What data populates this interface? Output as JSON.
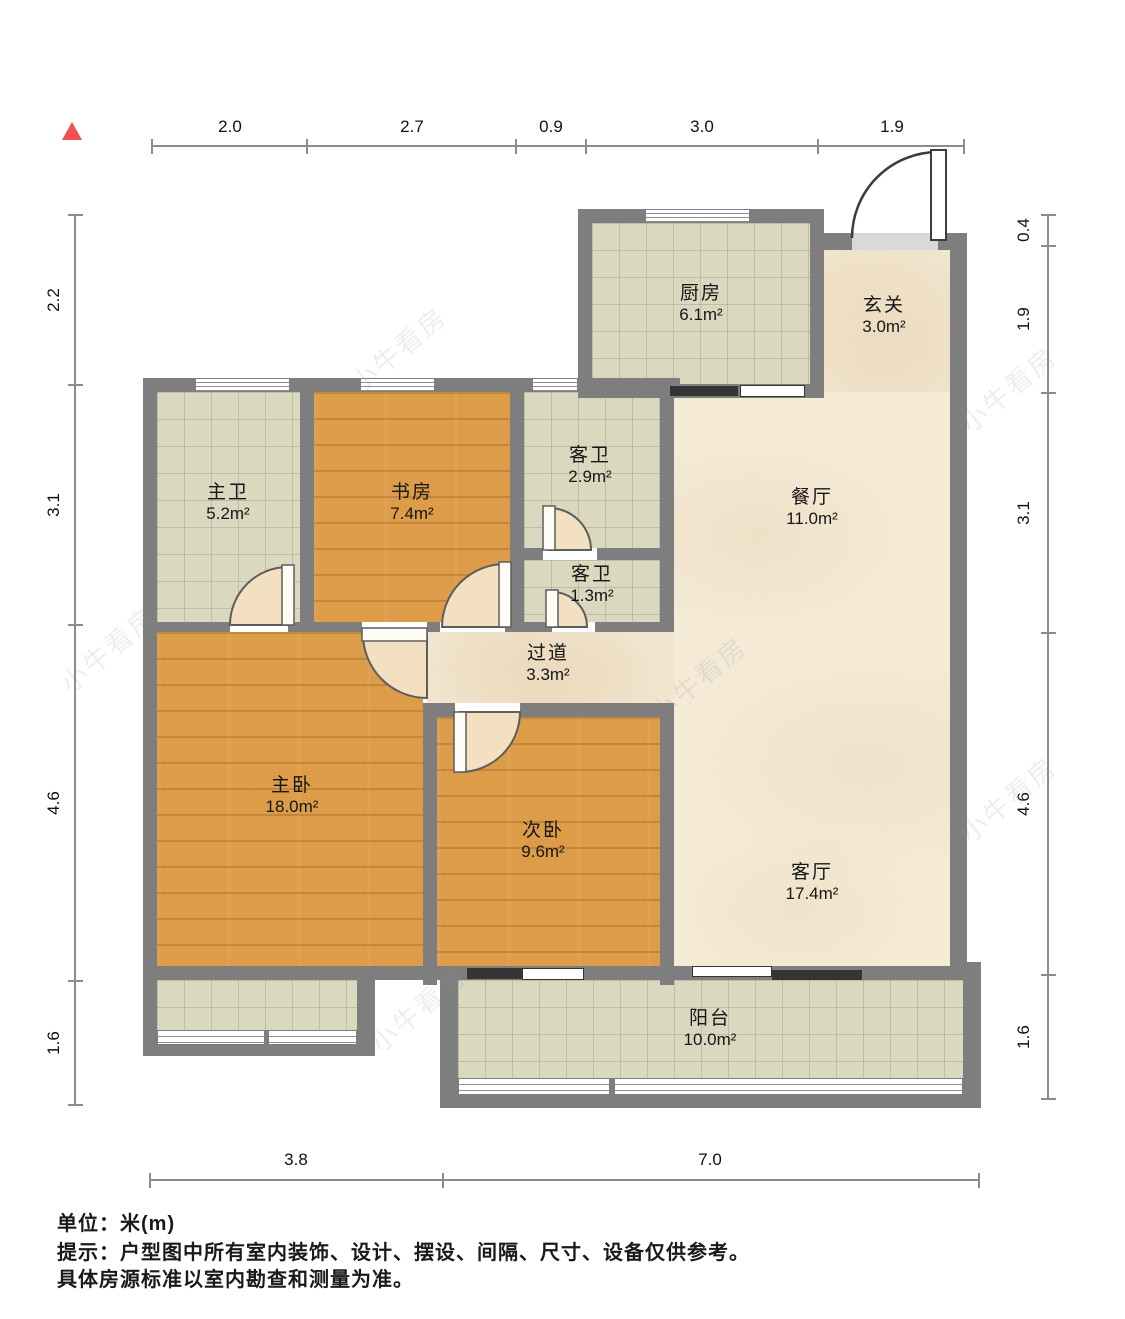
{
  "north_indicator": "north-arrow",
  "watermark": "小牛看房",
  "rooms": [
    {
      "id": "kitchen",
      "name": "厨房",
      "area": "6.1m²"
    },
    {
      "id": "entry",
      "name": "玄关",
      "area": "3.0m²"
    },
    {
      "id": "master-bath",
      "name": "主卫",
      "area": "5.2m²"
    },
    {
      "id": "study",
      "name": "书房",
      "area": "7.4m²"
    },
    {
      "id": "guest-bath-1",
      "name": "客卫",
      "area": "2.9m²"
    },
    {
      "id": "dining-room",
      "name": "餐厅",
      "area": "11.0m²"
    },
    {
      "id": "guest-bath-2",
      "name": "客卫",
      "area": "1.3m²"
    },
    {
      "id": "hallway",
      "name": "过道",
      "area": "3.3m²"
    },
    {
      "id": "master-bedroom",
      "name": "主卧",
      "area": "18.0m²"
    },
    {
      "id": "second-bedroom",
      "name": "次卧",
      "area": "9.6m²"
    },
    {
      "id": "living-room",
      "name": "客厅",
      "area": "17.4m²"
    },
    {
      "id": "balcony",
      "name": "阳台",
      "area": "10.0m²"
    }
  ],
  "dimensions": {
    "top": [
      "2.0",
      "2.7",
      "0.9",
      "3.0",
      "1.9"
    ],
    "left": [
      "2.2",
      "3.1",
      "4.6",
      "1.6"
    ],
    "right": [
      "0.4",
      "1.9",
      "3.1",
      "4.6",
      "1.6"
    ],
    "bottom": [
      "3.8",
      "7.0"
    ]
  },
  "footer": {
    "unit": "单位：米(m)",
    "tip_line1": "提示：户型图中所有室内装饰、设计、摆设、间隔、尺寸、设备仅供参考。",
    "tip_line2": "具体房源标准以室内勘查和测量为准。"
  },
  "colors": {
    "wall": "#7e7e7e",
    "wood_floor": "#dd9c48",
    "tile_floor": "#dad8bf",
    "marble_floor": "#f4ead6",
    "door_swing_fill": "#f3e0c0",
    "north_red": "#f05050",
    "window_track_dark": "#353535"
  }
}
